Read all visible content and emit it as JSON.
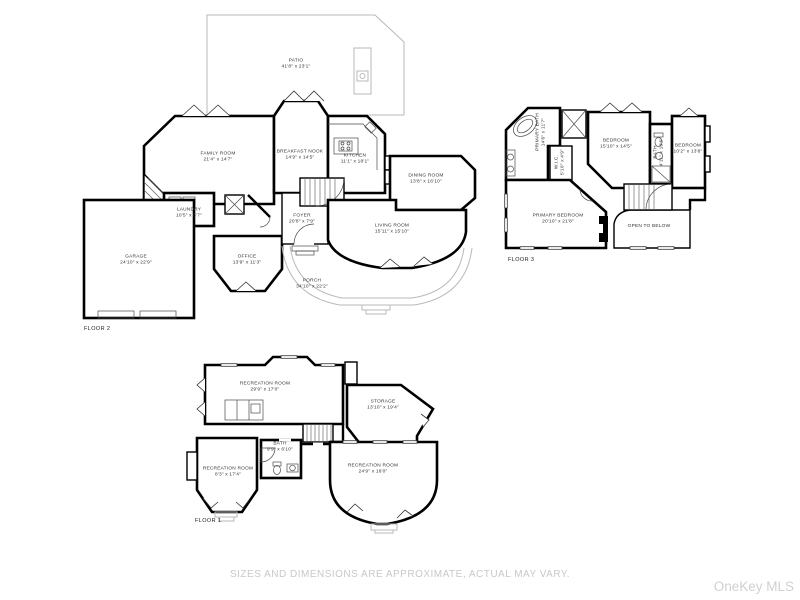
{
  "page": {
    "disclaimer": "SIZES AND DIMENSIONS ARE APPROXIMATE, ACTUAL MAY VARY.",
    "watermark": "OneKey MLS"
  },
  "colors": {
    "walls": "#000000",
    "patio_porch_outline": "#b8b8b8",
    "label_text": "#333333",
    "muted_text": "#c8c8c8"
  },
  "floor2": {
    "label": "FLOOR 2",
    "rooms": {
      "patio": {
        "name": "PATIO",
        "dims": "41'8\" x 23'1\""
      },
      "family": {
        "name": "FAMILY ROOM",
        "dims": "21'4\" x 14'7\""
      },
      "breakfast": {
        "name": "BREAKFAST NOOK",
        "dims": "14'9\" x 14'5\""
      },
      "kitchen": {
        "name": "KITCHEN",
        "dims": "11'1\" x 18'1\""
      },
      "dining": {
        "name": "DINING ROOM",
        "dims": "13'8\" x 16'10\""
      },
      "laundry": {
        "name": "LAUNDRY",
        "dims": "10'5\" x 6'7\""
      },
      "foyer": {
        "name": "FOYER",
        "dims": "20'8\" x 7'9\""
      },
      "living": {
        "name": "LIVING ROOM",
        "dims": "15'11\" x 15'10\""
      },
      "office": {
        "name": "OFFICE",
        "dims": "13'9\" x 11'3\""
      },
      "garage": {
        "name": "GARAGE",
        "dims": "24'10\" x 22'9\""
      },
      "porch": {
        "name": "PORCH",
        "dims": "34'10\" x 22'2\""
      }
    }
  },
  "floor3": {
    "label": "FLOOR 3",
    "rooms": {
      "primaryBath": {
        "name": "PRIMARY BATH",
        "dims": "14'6\" x 11'7\""
      },
      "wic": {
        "name": "W.I.C.",
        "dims": "5'10\" x 4'9\""
      },
      "bedroom1": {
        "name": "BEDROOM",
        "dims": "15'10\" x 14'5\""
      },
      "bath": {
        "name": "BATH",
        "dims": "4'11\" x 10'6\""
      },
      "bedroom2": {
        "name": "BEDROOM",
        "dims": "10'2\" x 13'8\""
      },
      "primaryBedroom": {
        "name": "PRIMARY BEDROOM",
        "dims": "20'10\" x 21'8\""
      },
      "openToBelow": {
        "name": "OPEN TO BELOW"
      }
    }
  },
  "floor1": {
    "label": "FLOOR 1",
    "rooms": {
      "rec1": {
        "name": "RECREATION ROOM",
        "dims": "29'9\" x 17'0\""
      },
      "storage": {
        "name": "STORAGE",
        "dims": "13'10\" x 19'4\""
      },
      "bath": {
        "name": "BATH",
        "dims": "9'9\" x 6'10\""
      },
      "rec2": {
        "name": "RECREATION ROOM",
        "dims": "8'3\" x 17'4\""
      },
      "rec3": {
        "name": "RECREATION ROOM",
        "dims": "24'9\" x 16'0\""
      }
    }
  }
}
